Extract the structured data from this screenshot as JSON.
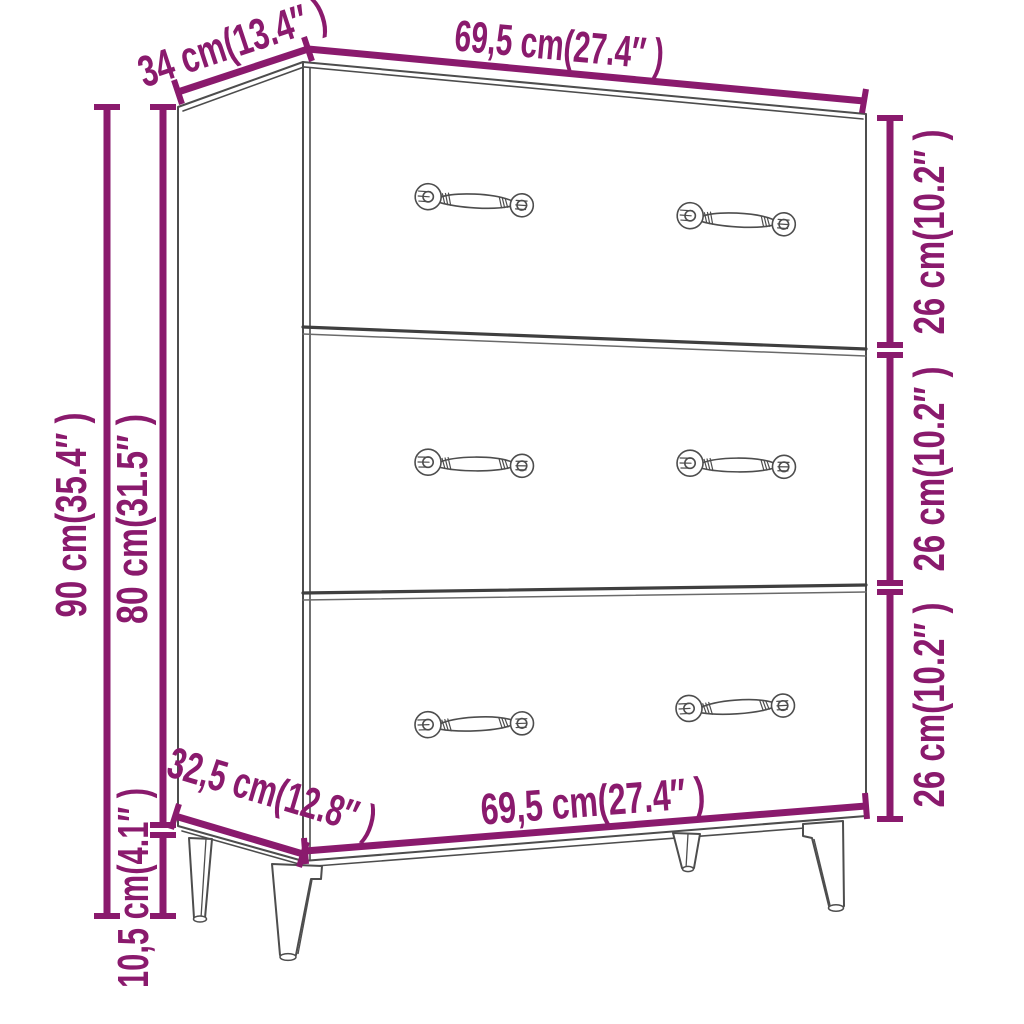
{
  "image": {
    "type": "product-dimension-diagram",
    "subject": "sideboard cabinet with three drawers and tapered legs"
  },
  "colors": {
    "background": "#ffffff",
    "dimension": "#8a1a6d",
    "outline": "#4d4d4d",
    "separator": "#3f3f3f"
  },
  "dimensions": {
    "top_width": "69,5 cm(27.4″ )",
    "top_depth": "34 cm(13.4″ )",
    "drawer_top_height": "26 cm(10.2″ )",
    "drawer_middle_height": "26 cm(10.2″ )",
    "drawer_bottom_height": "26 cm(10.2″ )",
    "total_height": "90 cm(35.4″ )",
    "body_height": "80 cm(31.5″ )",
    "bottom_depth": "32,5 cm(12.8″ )",
    "bottom_width": "69,5 cm(27.4″ )",
    "leg_height": "10,5 cm(4.1″ )"
  }
}
